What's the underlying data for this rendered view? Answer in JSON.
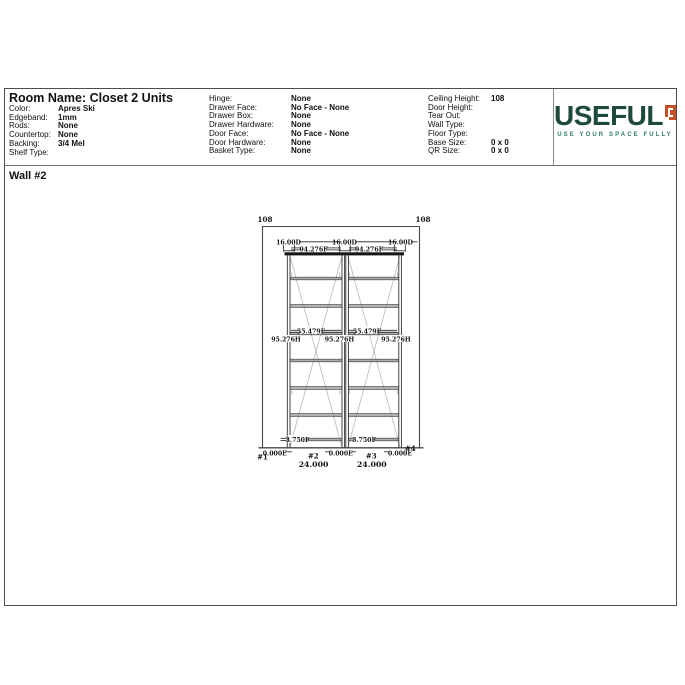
{
  "header": {
    "room_name": "Room Name: Closet 2 Units",
    "left_fields": [
      {
        "label": "Color:",
        "value": "Apres Ski"
      },
      {
        "label": "Edgeband:",
        "value": "1mm"
      },
      {
        "label": "Rods:",
        "value": "None"
      },
      {
        "label": "Countertop:",
        "value": "None"
      },
      {
        "label": "Backing:",
        "value": "3/4 Mel"
      },
      {
        "label": "Shelf Type:",
        "value": ""
      }
    ],
    "mid_fields": [
      {
        "label": "Hinge:",
        "value": "None"
      },
      {
        "label": "Drawer Face:",
        "value": "No Face - None"
      },
      {
        "label": "Drawer Box:",
        "value": "None"
      },
      {
        "label": "Drawer Hardware:",
        "value": "None"
      },
      {
        "label": "Door Face:",
        "value": "No Face - None"
      },
      {
        "label": "Door Hardware:",
        "value": "None"
      },
      {
        "label": "Basket Type:",
        "value": "None"
      }
    ],
    "right_fields": [
      {
        "label": "Ceiling Height:",
        "value": "108"
      },
      {
        "label": "Door Height:",
        "value": ""
      },
      {
        "label": "Tear Out:",
        "value": ""
      },
      {
        "label": "Wall Type:",
        "value": ""
      },
      {
        "label": "Floor Type:",
        "value": ""
      },
      {
        "label": "Base Size:",
        "value": "0 x 0"
      },
      {
        "label": "QR Size:",
        "value": "0 x 0"
      }
    ]
  },
  "logo": {
    "text": "USEFUL",
    "tagline": "USE YOUR SPACE FULLY",
    "brand_green": "#1d4a3a",
    "brand_orange": "#c2512a",
    "tagline_green": "#2e7d56"
  },
  "wall_section": {
    "title": "Wall #2"
  },
  "drawing": {
    "ceiling_left": "108",
    "ceiling_right": "108",
    "depth_labels": [
      "16.00D",
      "16.00D",
      "16.00D"
    ],
    "unit_width_labels": [
      "94.276F",
      "94.276F"
    ],
    "shelf_labels": [
      "55.479F",
      "55.479F"
    ],
    "panel_height_labels": [
      "95.276H",
      "95.276H",
      "95.276H"
    ],
    "toe_labels": [
      "3.750F",
      "3.750F"
    ],
    "edge_labels": [
      "0.000E",
      "0.000E",
      "0.000E"
    ],
    "panel_numbers": [
      "#1",
      "#2",
      "#3",
      "#4"
    ],
    "unit_widths": [
      "24.000",
      "24.000"
    ]
  }
}
